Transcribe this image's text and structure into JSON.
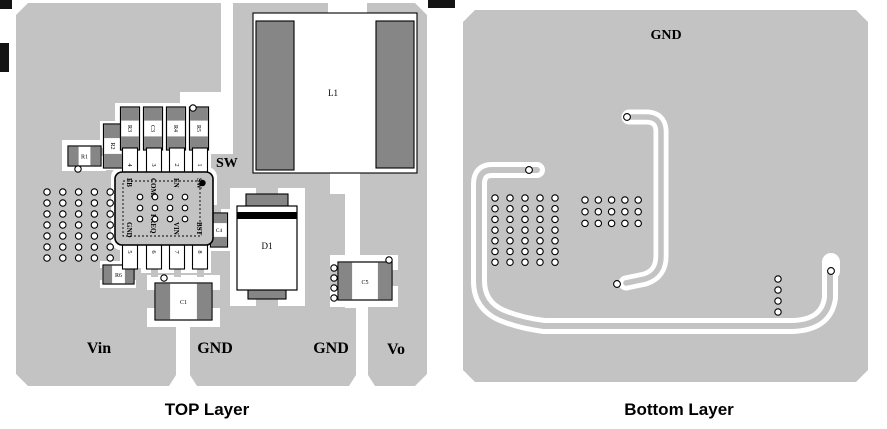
{
  "colors": {
    "pour_gray": "#c3c3c3",
    "pad_dark": "#868686",
    "silkscreen_black": "#000000",
    "board_white": "#ffffff"
  },
  "captions": {
    "top": "TOP Layer",
    "bottom": "Bottom Layer"
  },
  "top_layer": {
    "nets": {
      "sw": "SW",
      "vin": "Vin",
      "gnd1": "GND",
      "gnd2": "GND",
      "vo": "Vo"
    },
    "refs": {
      "l1": "L1",
      "d1": "D1",
      "c1": "C1",
      "c4": "C4",
      "c5": "C5",
      "r1": "R1",
      "r2": "R2",
      "r3": "R3",
      "c3": "C3",
      "r4": "R4",
      "r5": "R5",
      "r6": "R6"
    },
    "ic": {
      "pins_top": [
        "FB",
        "COMP",
        "EN",
        "SW"
      ],
      "pads_top": [
        "4",
        "3",
        "2",
        "1"
      ],
      "pins_bottom": [
        "GND",
        "FREQ",
        "VIN",
        "BST"
      ],
      "pads_bottom": [
        "5",
        "6",
        "7",
        "8"
      ]
    }
  },
  "bottom_layer": {
    "nets": {
      "gnd": "GND"
    }
  }
}
